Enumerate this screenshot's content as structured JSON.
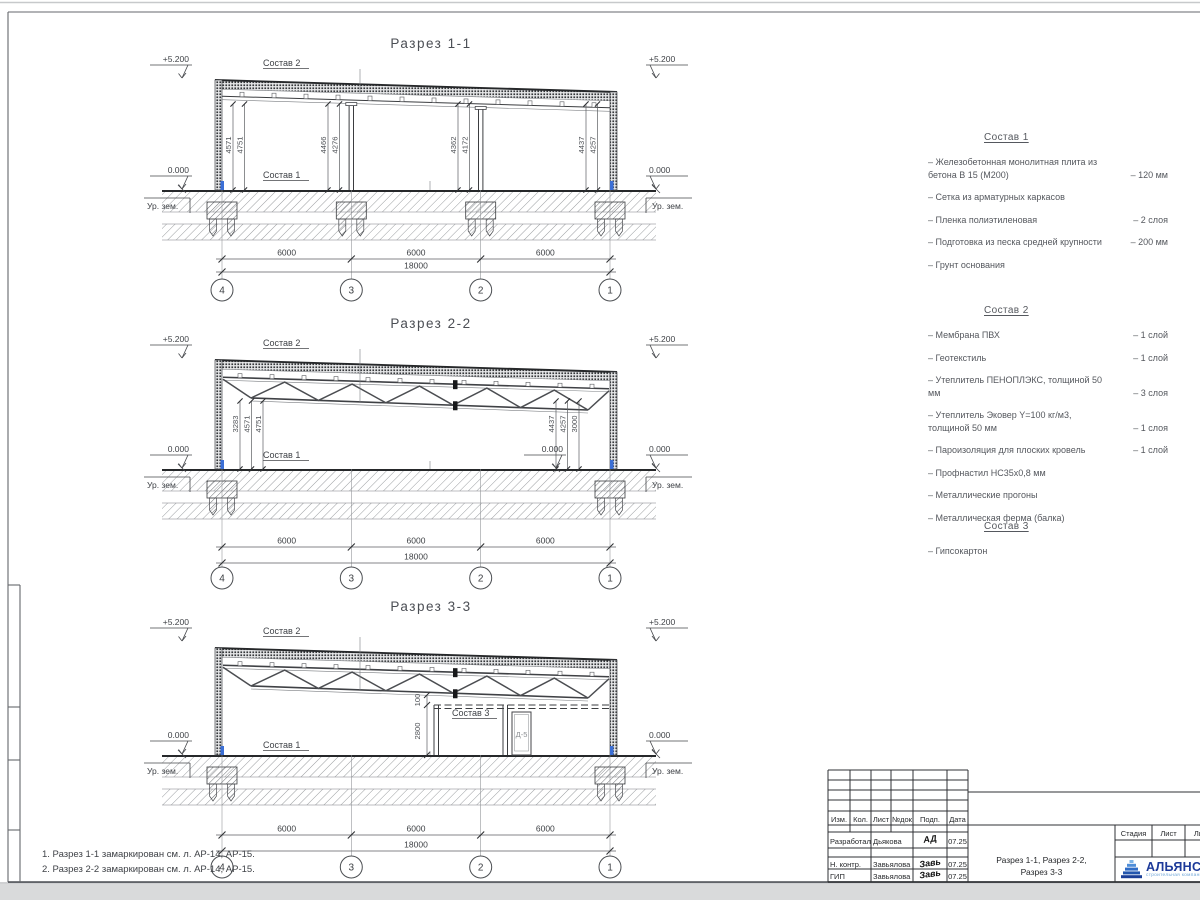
{
  "sheet": {
    "notes": [
      "1. Разрез 1-1 замаркирован см. л. АР-14, АР-15.",
      "2. Разрез 2-2 замаркирован см. л. АР-14, АР-15."
    ]
  },
  "colors": {
    "anchor_blue": "#3b6fd6",
    "logo_blue": "#1d3a99",
    "logo_light": "#6fa6d8"
  },
  "sections": [
    {
      "id": "1-1",
      "title": "Разрез 1-1",
      "elev_top": "+5.200",
      "elev_zero": "0.000",
      "ground": "Ур. зем.",
      "label_top": "Состав 2",
      "label_floor": "Состав 1",
      "vdims": [
        [
          "4571",
          "4751"
        ],
        [
          "4466",
          "4276"
        ],
        [
          "4362",
          "4172"
        ],
        [
          "4437",
          "4257"
        ]
      ],
      "dims": [
        "6000",
        "6000",
        "6000"
      ],
      "total": "18000",
      "grid": [
        "4",
        "3",
        "2",
        "1"
      ]
    },
    {
      "id": "2-2",
      "title": "Разрез 2-2",
      "elev_top": "+5.200",
      "elev_zero": "0.000",
      "inner_zero": "0.000",
      "ground": "Ур. зем.",
      "label_top": "Состав 2",
      "label_floor": "Состав 1",
      "vdims": [
        [
          "3283",
          "4571",
          "4751"
        ],
        [
          "4437",
          "4257",
          "3000"
        ]
      ],
      "dims": [
        "6000",
        "6000",
        "6000"
      ],
      "total": "18000",
      "grid": [
        "4",
        "3",
        "2",
        "1"
      ]
    },
    {
      "id": "3-3",
      "title": "Разрез 3-3",
      "elev_top": "+5.200",
      "elev_zero": "0.000",
      "ground": "Ур. зем.",
      "label_top": "Состав 2",
      "label_floor": "Состав 1",
      "partition": {
        "label": "Состав 3",
        "door": "Д-5",
        "dim_top": "100",
        "dim_height": "2800"
      },
      "vdims": [],
      "dims": [
        "6000",
        "6000",
        "6000"
      ],
      "total": "18000",
      "grid": [
        "4",
        "3",
        "2",
        "1"
      ]
    }
  ],
  "materials": [
    {
      "title": "Состав 1",
      "items": [
        {
          "name": "– Железобетонная  монолитная плита из бетона В 15 (М200)",
          "qty": "– 120 мм"
        },
        {
          "name": "– Сетка из арматурных каркасов",
          "qty": ""
        },
        {
          "name": "– Пленка полиэтиленовая",
          "qty": "– 2 слоя"
        },
        {
          "name": "– Подготовка из песка средней крупности",
          "qty": "– 200 мм"
        },
        {
          "name": "– Грунт основания",
          "qty": ""
        }
      ]
    },
    {
      "title": "Состав 2",
      "items": [
        {
          "name": "– Мембрана ПВХ",
          "qty": "– 1 слой"
        },
        {
          "name": "– Геотекстиль",
          "qty": "– 1 слой"
        },
        {
          "name": "– Утеплитель ПЕНОПЛЭКС, толщиной 50 мм",
          "qty": "– 3 слоя"
        },
        {
          "name": "– Утеплитель Эковер Y=100 кг/м3, толщиной 50 мм",
          "qty": "– 1 слоя"
        },
        {
          "name": "– Пароизоляция для плоских кровель",
          "qty": "– 1 слой"
        },
        {
          "name": "– Профнастил НС35х0,8 мм",
          "qty": ""
        },
        {
          "name": "– Металлические прогоны",
          "qty": ""
        },
        {
          "name": "– Металлическая ферма (балка)",
          "qty": ""
        }
      ]
    },
    {
      "title": "Состав 3",
      "items": [
        {
          "name": "– Гипсокартон",
          "qty": ""
        }
      ]
    }
  ],
  "title_block": {
    "headers": [
      "Изм.",
      "Кол.",
      "Лист",
      "№док",
      "Подп.",
      "Дата"
    ],
    "rows": [
      {
        "role": "Разработал",
        "name": "Дьякова",
        "sig": "АД",
        "date": "07.25"
      },
      {
        "role": "Н. контр.",
        "name": "Завьялова",
        "sig": "Завь",
        "date": "07.25"
      },
      {
        "role": "ГИП",
        "name": "Завьялова",
        "sig": "Завь",
        "date": "07.25"
      }
    ],
    "doc_title_line1": "Разрез 1-1, Разрез 2-2,",
    "doc_title_line2": "Разрез 3-3",
    "stage_headers": [
      "Стадия",
      "Лист",
      "Листов"
    ],
    "company": {
      "name": "АЛЬЯНС",
      "tagline": "строительная компания"
    }
  }
}
